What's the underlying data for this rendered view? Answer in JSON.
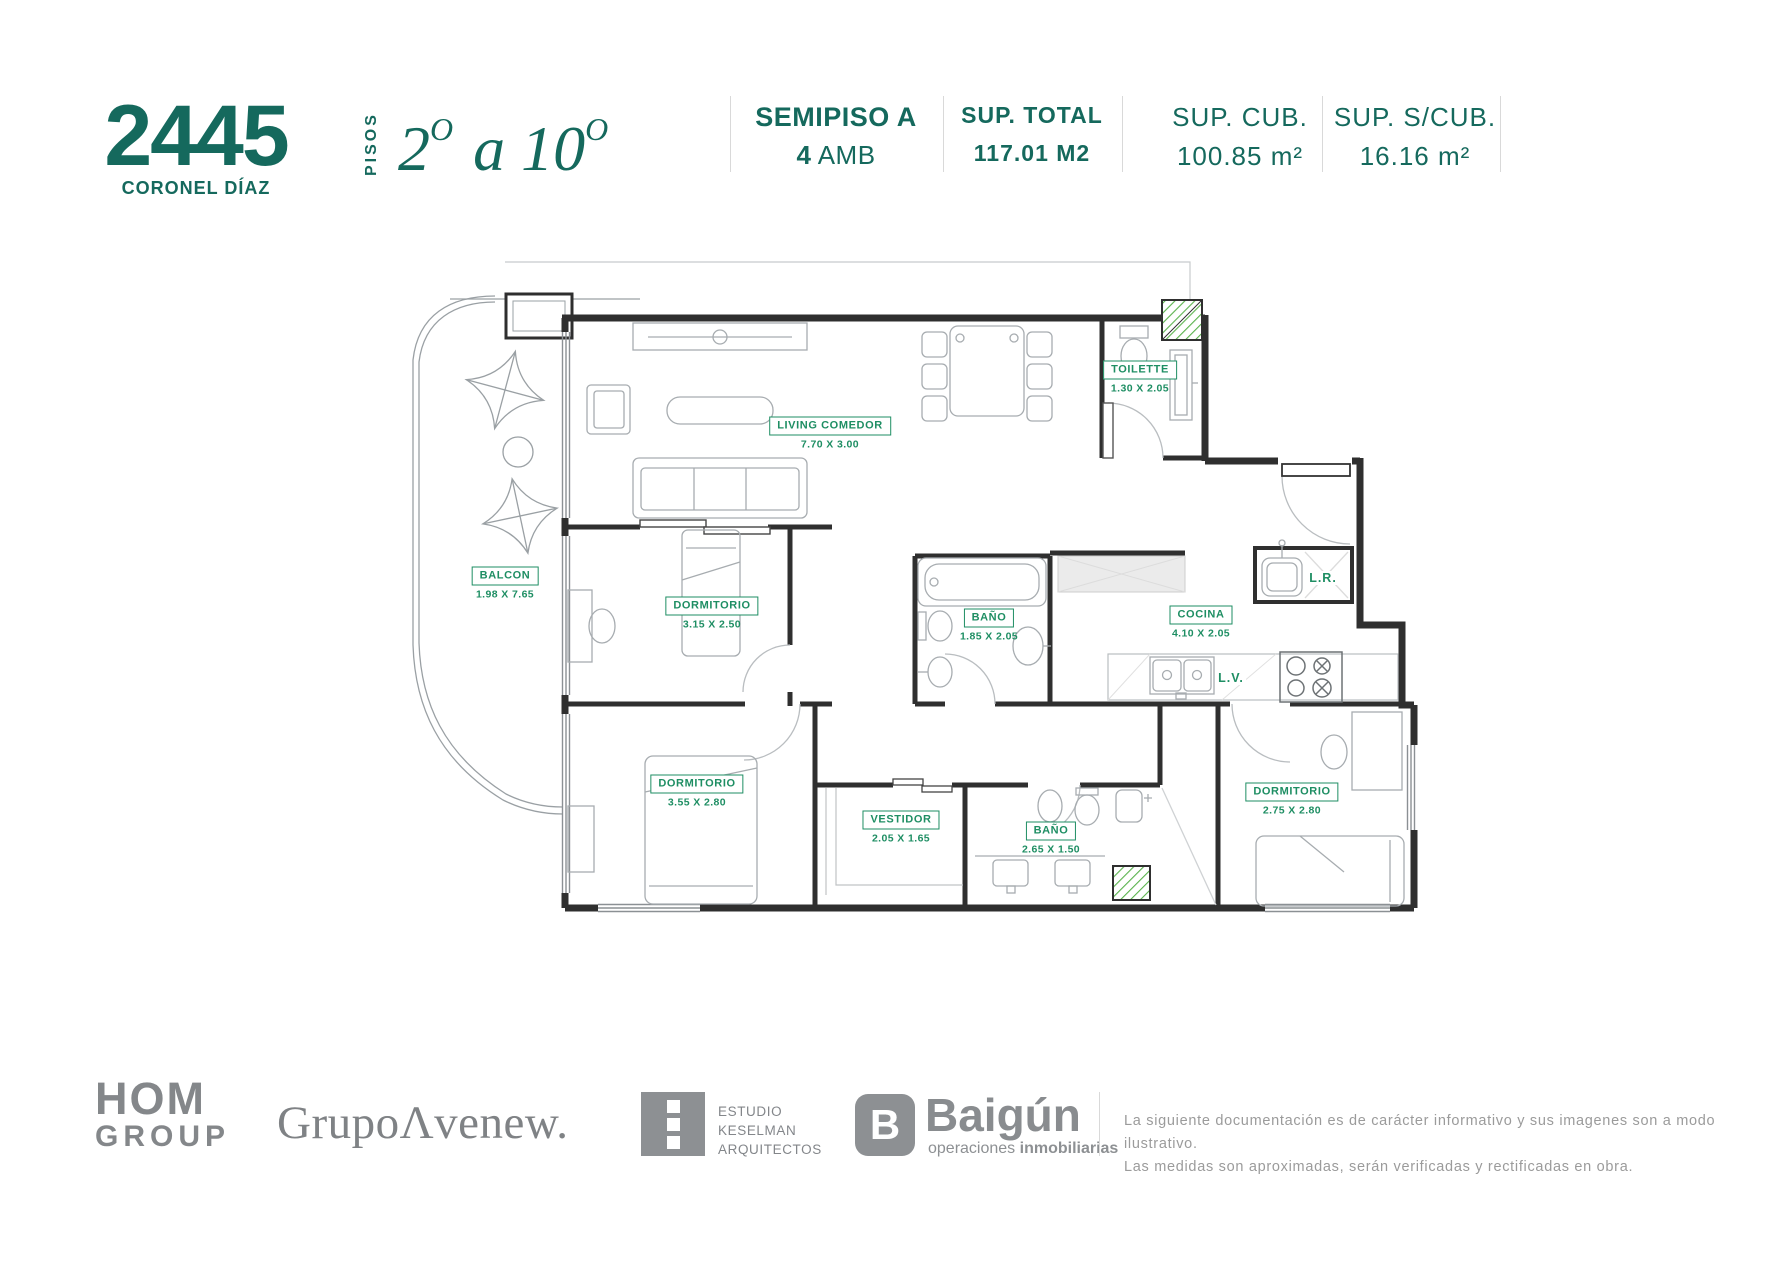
{
  "header": {
    "building_number": "2445",
    "street": "CORONEL DÍAZ",
    "floors_label": "PISOS",
    "floors_from": "2",
    "floors_sup": "O",
    "floors_sep": " a ",
    "floors_to": "10",
    "unit_title": "SEMIPISO A",
    "unit_amb_value": "4",
    "unit_amb_label": "AMB",
    "sup_total_label": "SUP. TOTAL",
    "sup_total_value": "117.01 M2",
    "sup_cub_label": "SUP. CUB.",
    "sup_cub_value": "100.85 m²",
    "sup_scub_label": "SUP. S/CUB.",
    "sup_scub_value": "16.16 m²"
  },
  "plan": {
    "rooms": [
      {
        "name": "LIVING COMEDOR",
        "dim": "7.70 X 3.00"
      },
      {
        "name": "TOILETTE",
        "dim": "1.30 X 2.05"
      },
      {
        "name": "BALCON",
        "dim": "1.98 X 7.65"
      },
      {
        "name": "DORMITORIO",
        "dim": "3.15 X 2.50"
      },
      {
        "name": "BAÑO",
        "dim": "1.85 X 2.05"
      },
      {
        "name": "COCINA",
        "dim": "4.10 X 2.05"
      },
      {
        "name": "DORMITORIO",
        "dim": "3.55 X 2.80"
      },
      {
        "name": "VESTIDOR",
        "dim": "2.05 X 1.65"
      },
      {
        "name": "BAÑO",
        "dim": "2.65 X 1.50"
      },
      {
        "name": "DORMITORIO",
        "dim": "2.75 X 2.80"
      }
    ],
    "tags": {
      "lr": "L.R.",
      "lv": "L.V."
    }
  },
  "footer": {
    "hom_line1": "HOM",
    "hom_line2": "GROUP",
    "avenew": "GrupoΛvenew.",
    "keselman_1": "ESTUDIO",
    "keselman_2": "KESELMAN",
    "keselman_3": "ARQUITECTOS",
    "baigun_logo_letter": "B",
    "baigun_name": "Baigún",
    "baigun_tag_light": "operaciones ",
    "baigun_tag_bold": "inmobiliarias",
    "disclaimer_1": "La siguiente documentación es de carácter informativo y sus imagenes son a modo ilustrativo.",
    "disclaimer_2": "Las medidas son aproximadas, serán verificadas y rectificadas en obra."
  },
  "colors": {
    "teal": "#15695D",
    "label_green": "#1E8E63",
    "hatch_green": "#5ab34d",
    "wall": "#2f2f2f"
  }
}
